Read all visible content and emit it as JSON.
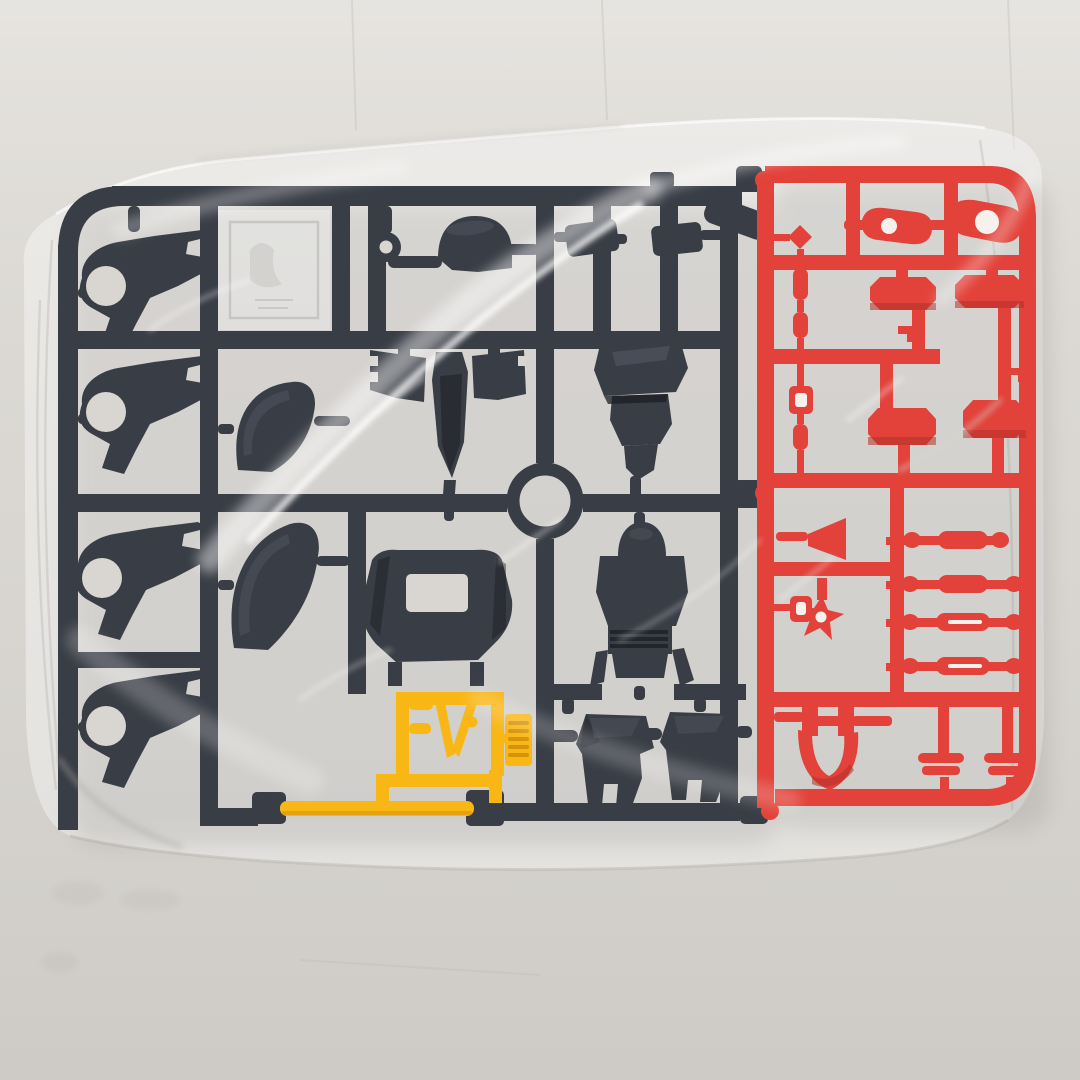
{
  "scene": {
    "description": "Photograph of plastic model-kit runner sprues sealed inside a clear glossy polybag lying on a light grey table",
    "objects": {
      "bag": "clear plastic bag with wrinkle highlights",
      "dark_sprue": "dark gunmetal runner: 4 leg parts with round holes, name plate, donut ring, helmet shell, winged backpack, large ring, torso, chest plate with window, vented backpack, 2 boot parts, 2 small boxes, angled part, 2 shoulder shells",
      "red_sprue": "red runner: 2 eye parts with holes, 4 armor pads, parts chain, cone, star part, 4 rod parts, collar part, 2 small bar parts",
      "yellow_runner": "yellow runner: V-fin antenna, F-bracket, vent louver part, long cross bar"
    },
    "part_counts": {
      "dark_leg_parts": 4,
      "shoulder_shells": 2,
      "boots": 2,
      "red_pads": 4,
      "red_rods": 4,
      "eye_parts": 2,
      "v_fin": 1
    }
  },
  "colors": {
    "table": "#d8d5d0",
    "bag_film": "#ffffff",
    "bag_shadow": "#b9b6b1",
    "dark_sprue": "#393d45",
    "dark_part_highlight": "#5d626c",
    "dark_part_shadow": "#1b1e23",
    "hole": "#d9d6d1",
    "red_sprue": "#e2423a",
    "red_dark": "#b23028",
    "red_hole": "#f6f1ec",
    "yellow": "#f9b716",
    "yellow_dark": "#d4940a"
  }
}
